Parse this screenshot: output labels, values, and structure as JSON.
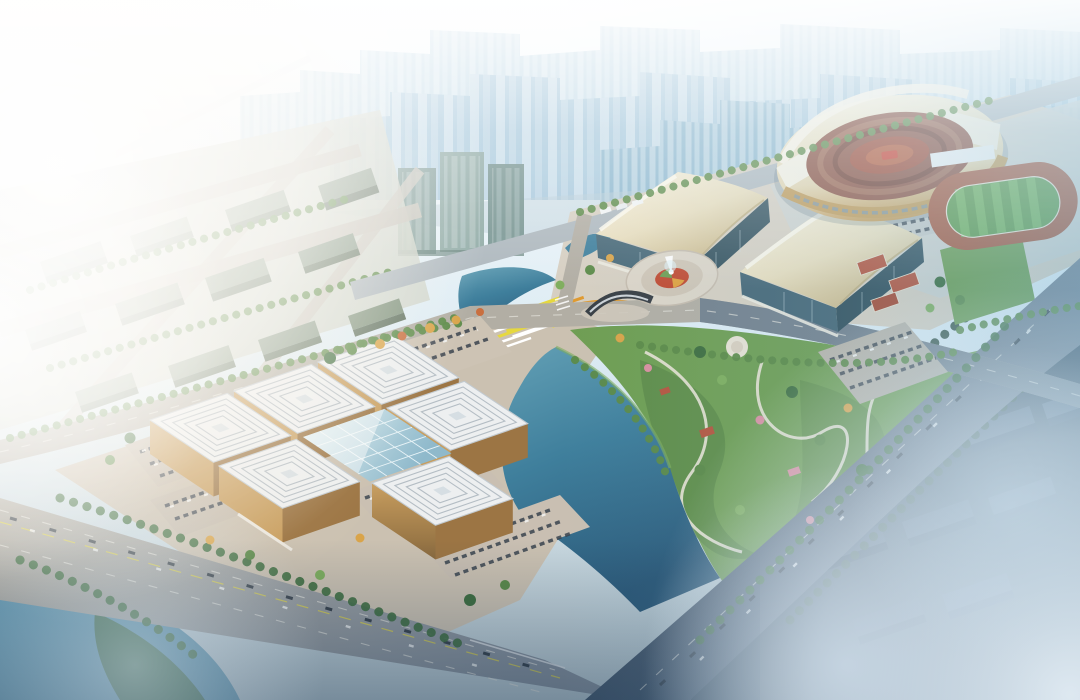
{
  "meta": {
    "canvas_width": 1080,
    "canvas_height": 700,
    "scene_type": "aerial-architectural-rendering"
  },
  "scene": {
    "landmarks": [
      "city-skyline-haze",
      "stadium",
      "athletics-practice-field",
      "tennis-courts",
      "convention-hall-west",
      "convention-hall-east",
      "fountain-plaza",
      "gateway-arch-sculpture",
      "flower-bed-plaza",
      "museum-complex",
      "museum-glass-atrium",
      "riverside-park-east",
      "crescent-pond-north",
      "central-pond",
      "west-lake",
      "boulevard-southwest",
      "highway-east",
      "avenue-north",
      "cross-avenue",
      "parking-lots",
      "office-district-west",
      "office-towers-center",
      "residential-district-southeast",
      "fog-and-sunlight"
    ]
  },
  "palette": {
    "sky_top": "#fbfdfe",
    "sky_haze": "#dcebf3",
    "skyline_far": "#bcd6e4",
    "skyline_mid": "#a3c6da",
    "skyline_near": "#8cb6ce",
    "tower_green": "#7e9a96",
    "ground_warm": "#cbc1b1",
    "ground_pale": "#d6cfc2",
    "ground_cool": "#ccd1cf",
    "road_warm": "#b2aea4",
    "road_cool": "#7c8896",
    "road_dark": "#42556a",
    "road_north": "#aeb8be",
    "park_green": "#6f9e53",
    "lawn": "#9dbd62",
    "tree_dark": "#3f6e3f",
    "tree_mid": "#5c8a48",
    "tree_light": "#7fae5e",
    "tree_autumn": "#d9a44a",
    "tree_pink": "#d98fa0",
    "tree_orange": "#c96f3f",
    "water_light": "#63a0b5",
    "water_mid": "#3f7f9c",
    "water_dark": "#2a5878",
    "lake": "#4d87a3",
    "museum_roof": "#edeff0",
    "museum_line": "#b4bdc4",
    "museum_gold": "#c89e5f",
    "museum_gold_dark": "#9c7544",
    "glass_light": "#cfe6ee",
    "glass_dark": "#8fb9cb",
    "conv_roof_light": "#f7f1de",
    "conv_roof_dark": "#c9b688",
    "conv_glass": "#35525e",
    "stadium_ring_light": "#f4eed9",
    "stadium_ring_dark": "#c39a58",
    "stadium_bowl": "#8a5040",
    "stadium_field": "#9e4a36",
    "stadium_gold": "#c09a58",
    "track_red": "#a65a40",
    "pitch_green": "#5e9a4b",
    "pitch_stripe": "#73b15c",
    "flower_yellow": "#e6d83f",
    "flower_orange": "#e09a2f",
    "court_red": "#b5563f",
    "district_dark_top": "#44586c",
    "district_dark_side": "#2e4254",
    "district_west_top": "#9cab9b",
    "district_west_side": "#788a78",
    "fog": "#e2ecf4",
    "sun_warm": "#ffeccb",
    "dusk": "#1f3a55",
    "path_light": "#e8e2d4",
    "car_dark": "#39434e"
  }
}
